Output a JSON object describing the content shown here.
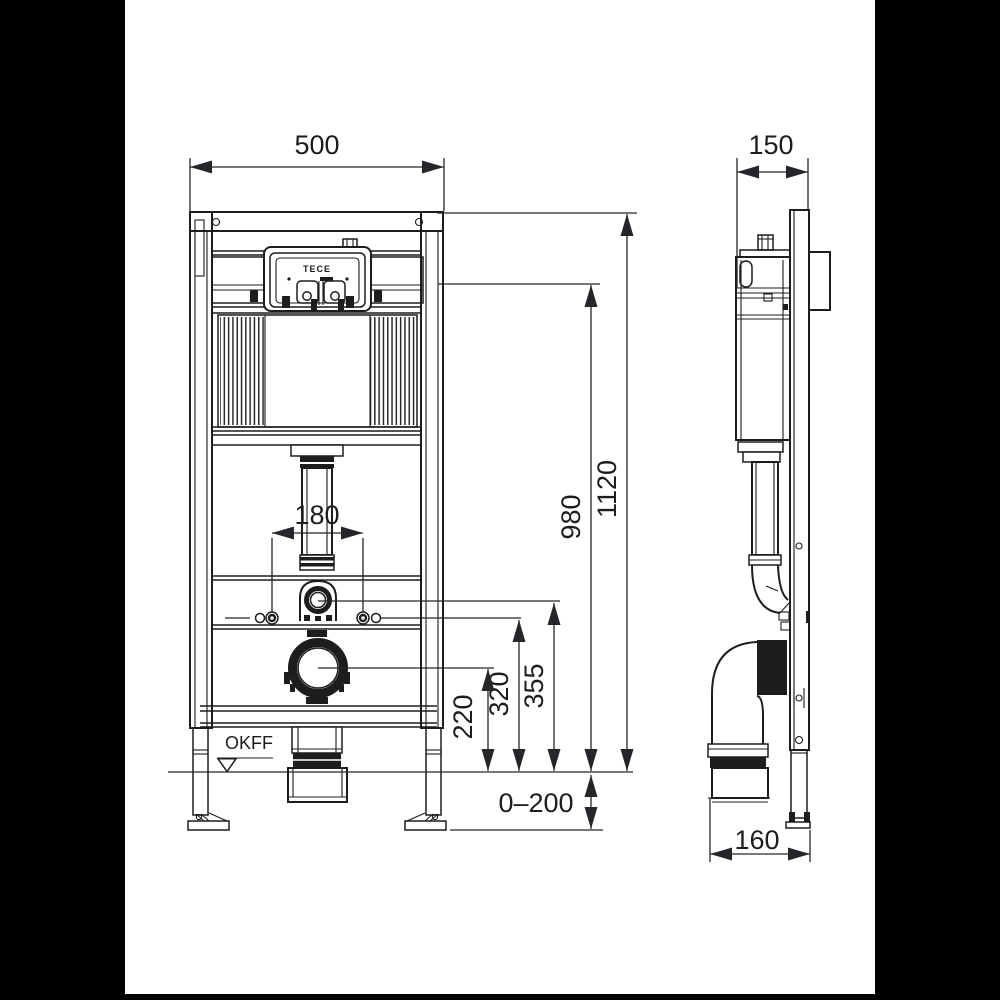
{
  "colors": {
    "line": "#1d1d1b",
    "background": "#ffffff",
    "letterbox": "#000000"
  },
  "branding": {
    "logo": "TECE"
  },
  "annotations": {
    "floor_level": "OKFF"
  },
  "dimensions": {
    "front_width": "500",
    "side_depth": "150",
    "overall_height": "1120",
    "upper_edge_height": "980",
    "flush_bend_height": "355",
    "fixing_bolt_height": "320",
    "drain_center_height": "220",
    "fixing_bolt_spacing": "180",
    "height_adjustment": "0–200",
    "drain_front_offset": "160"
  }
}
